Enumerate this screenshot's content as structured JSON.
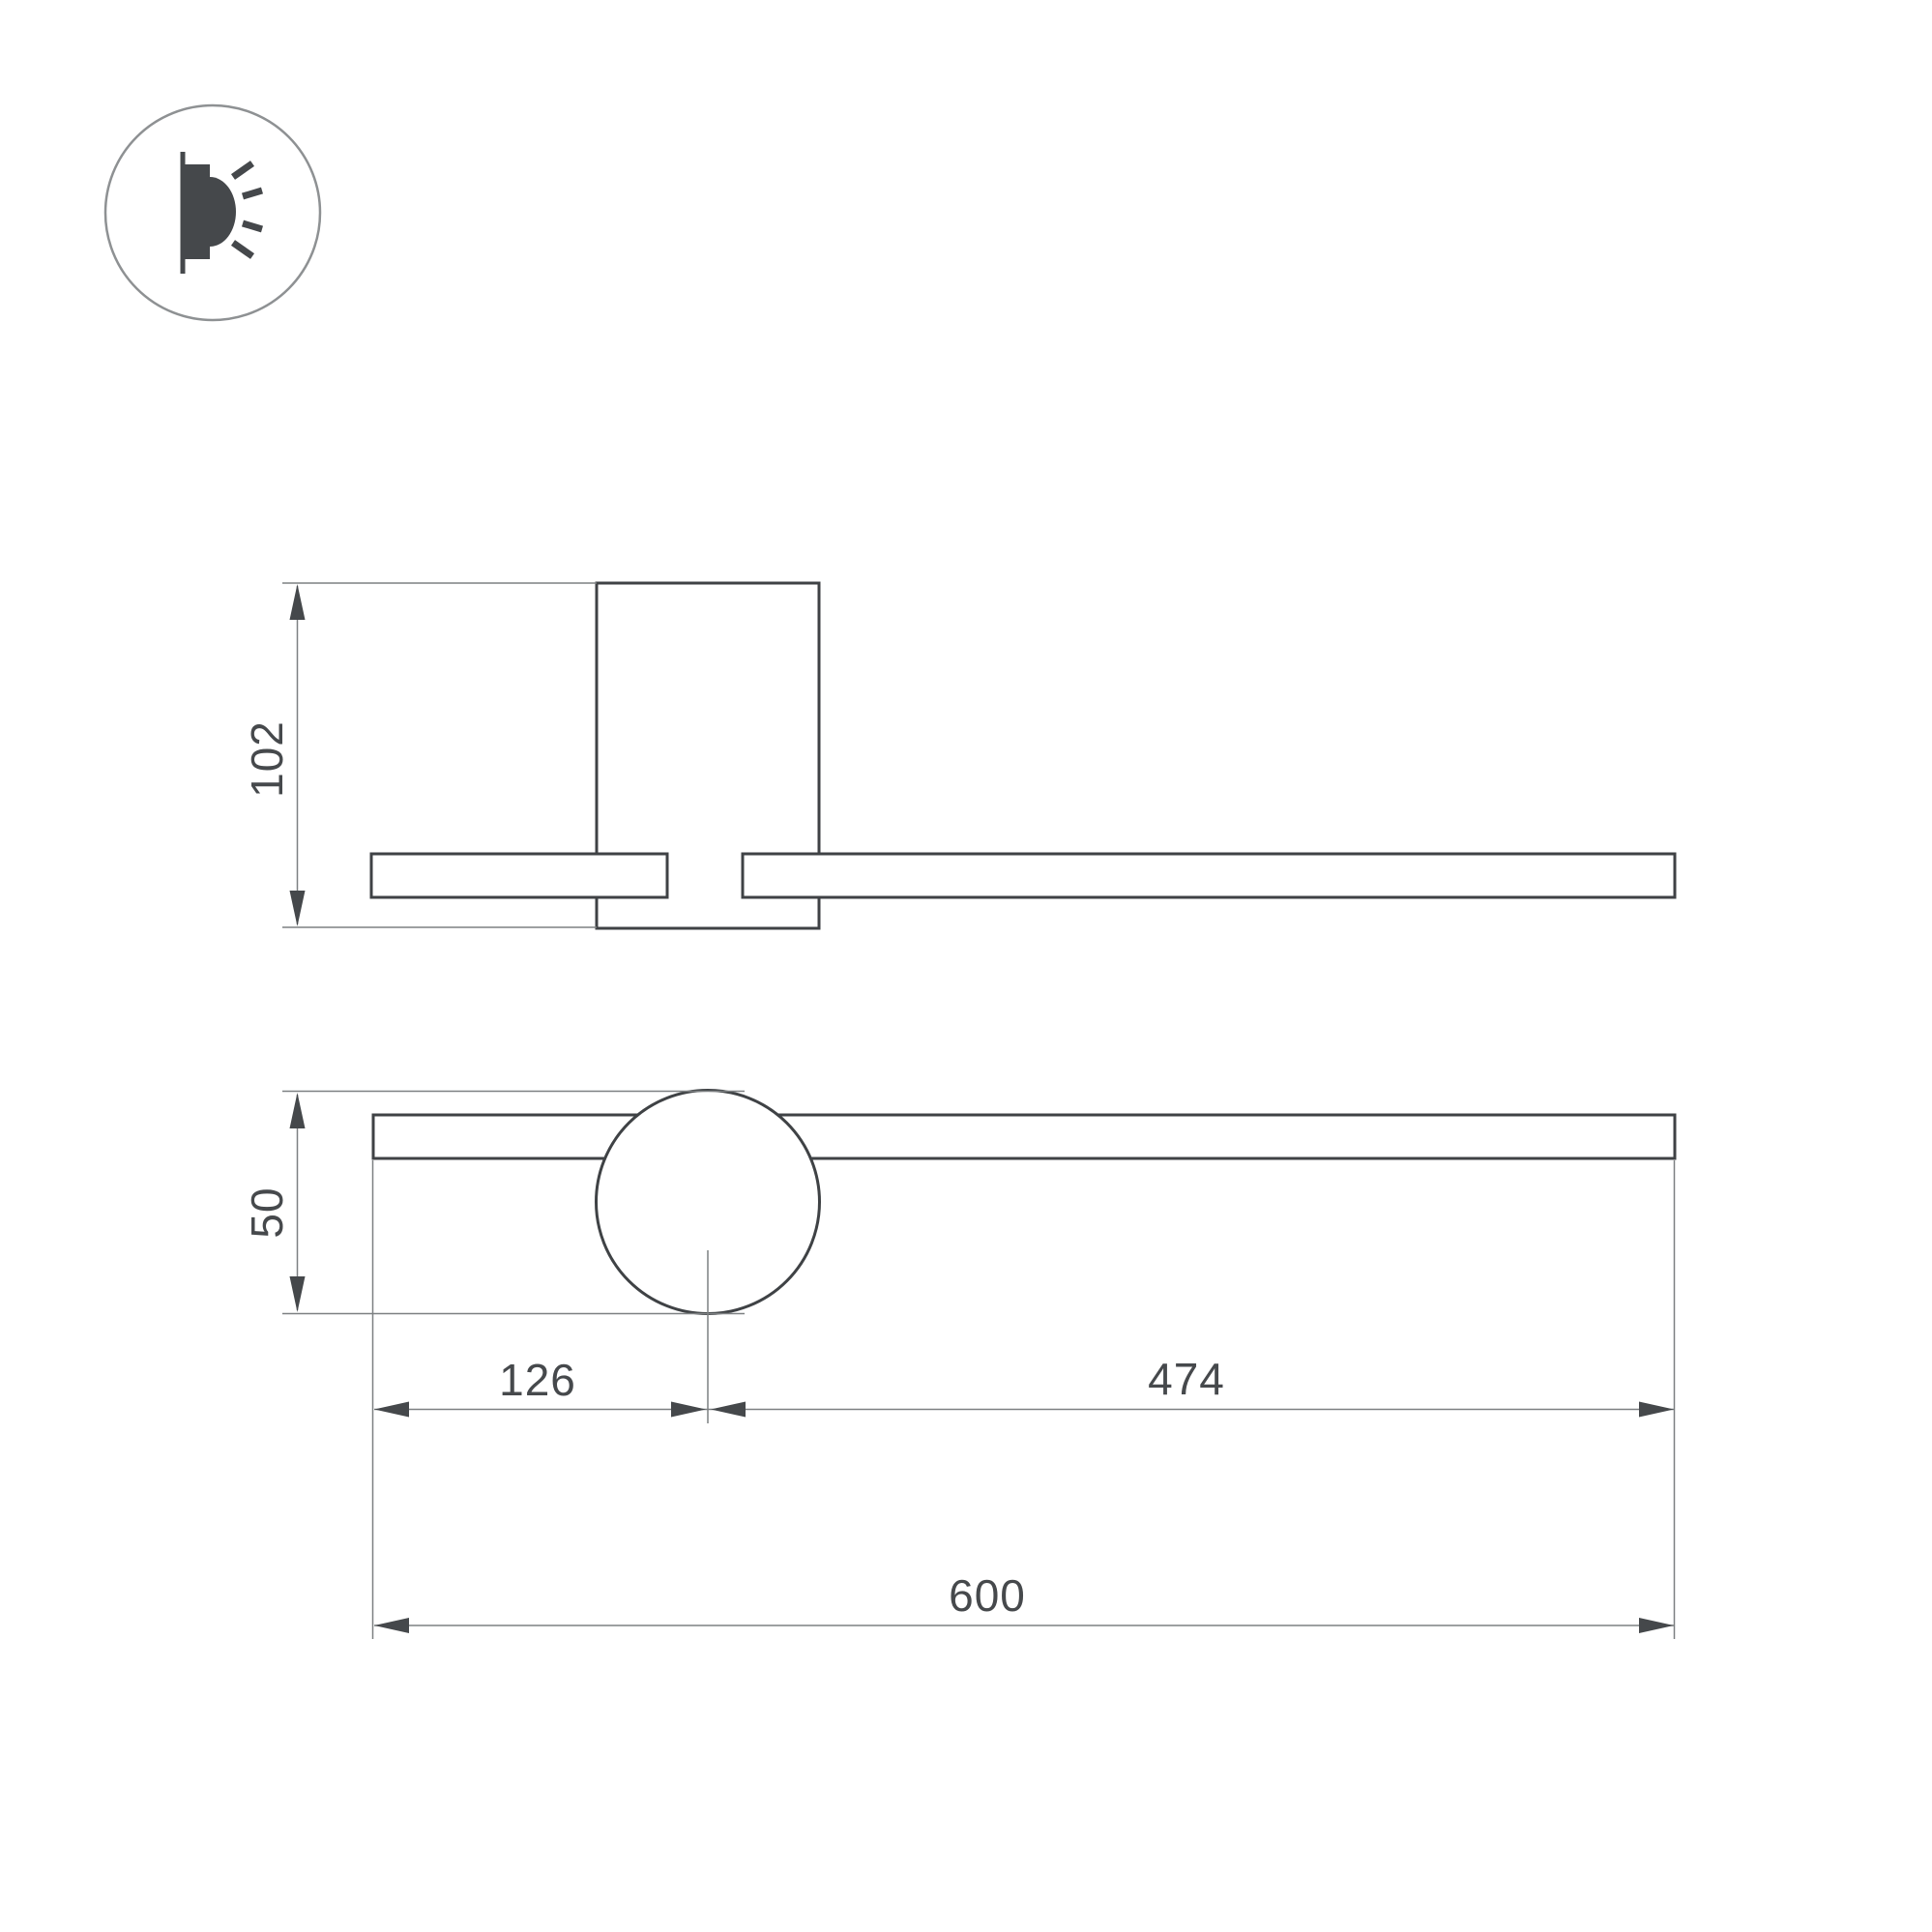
{
  "drawing": {
    "title": "wall-lamp-dimension-drawing",
    "background_color": "#ffffff",
    "outline_color": "#3f4245",
    "thin_line_color": "#7d8082",
    "arrow_color": "#45484b",
    "text_color": "#46494c",
    "icon": {
      "name": "wall-light-emission-icon",
      "glyph": "wall lamp side profile with light rays"
    },
    "side_view": {
      "height_label": "102"
    },
    "front_view": {
      "diameter_label": "50",
      "offset_label": "126",
      "arm_label": "474",
      "total_label": "600"
    }
  }
}
